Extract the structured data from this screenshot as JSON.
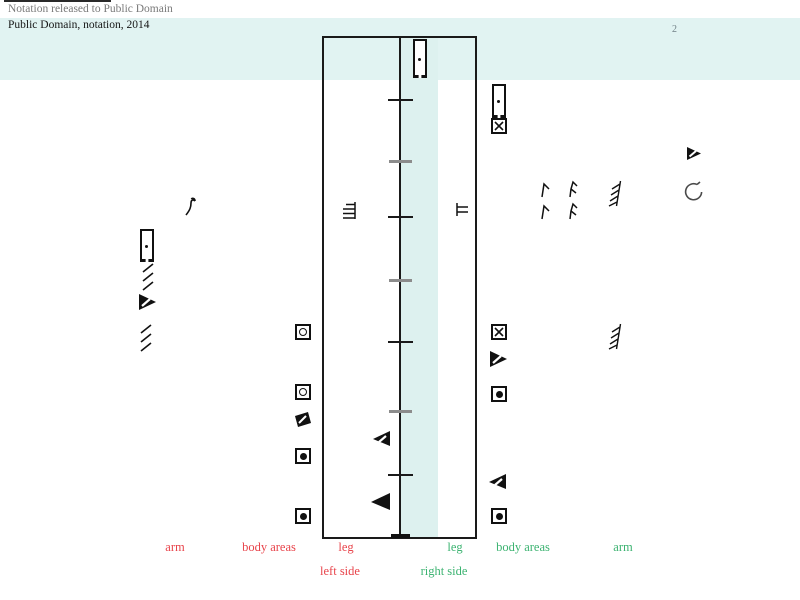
{
  "header": {
    "release_note": "Notation released to Public Domain",
    "title": "Public Domain, notation, 2014",
    "page_number": "2"
  },
  "columns": {
    "arm_left": "arm",
    "body_left": "body areas",
    "leg_left": "leg",
    "leg_right": "leg",
    "body_right": "body areas",
    "arm_right": "arm"
  },
  "sides": {
    "left": "left side",
    "right": "right side"
  },
  "colors": {
    "left_accent": "#e8444b",
    "right_accent": "#3cb371",
    "band_background": "#e1f3f2",
    "staff_strip": "#ddf1ef",
    "ink": "#111111",
    "gray_text": "#7a7a7a"
  },
  "staff": {
    "beat_tick_count": 7,
    "tick_styles": [
      "black",
      "gray",
      "black",
      "gray",
      "black",
      "gray",
      "black"
    ]
  },
  "icons": {
    "margin_left": [
      "eighth-rest-hook-icon",
      "presign-box-dot-icon",
      "triple-hatch-icon",
      "slashed-triangle-right-icon",
      "triple-hatch-icon"
    ],
    "staff_left_column": [
      "ring-square-icon",
      "ring-square-icon",
      "black-slashed-square-icon",
      "dot-square-icon",
      "dot-square-icon"
    ],
    "inside_staff": [
      "presign-box-dot-icon",
      "triple-bar-icon",
      "double-bar-icon",
      "slashed-triangle-left-icon",
      "solid-triangle-left-icon"
    ],
    "right_column": [
      "presign-box-dot-icon",
      "x-square-icon",
      "x-square-icon",
      "slashed-triangle-right-icon",
      "dot-square-icon",
      "slashed-triangle-left-icon",
      "dot-square-icon"
    ],
    "margin_right": [
      "hook-flag-icon",
      "hook-flag-icon",
      "double-hook-flag-icon",
      "double-hook-flag-icon",
      "fringe-hatch-icon",
      "slashed-triangle-right-icon",
      "rotation-arrow-icon",
      "fringe-hatch-icon"
    ]
  }
}
